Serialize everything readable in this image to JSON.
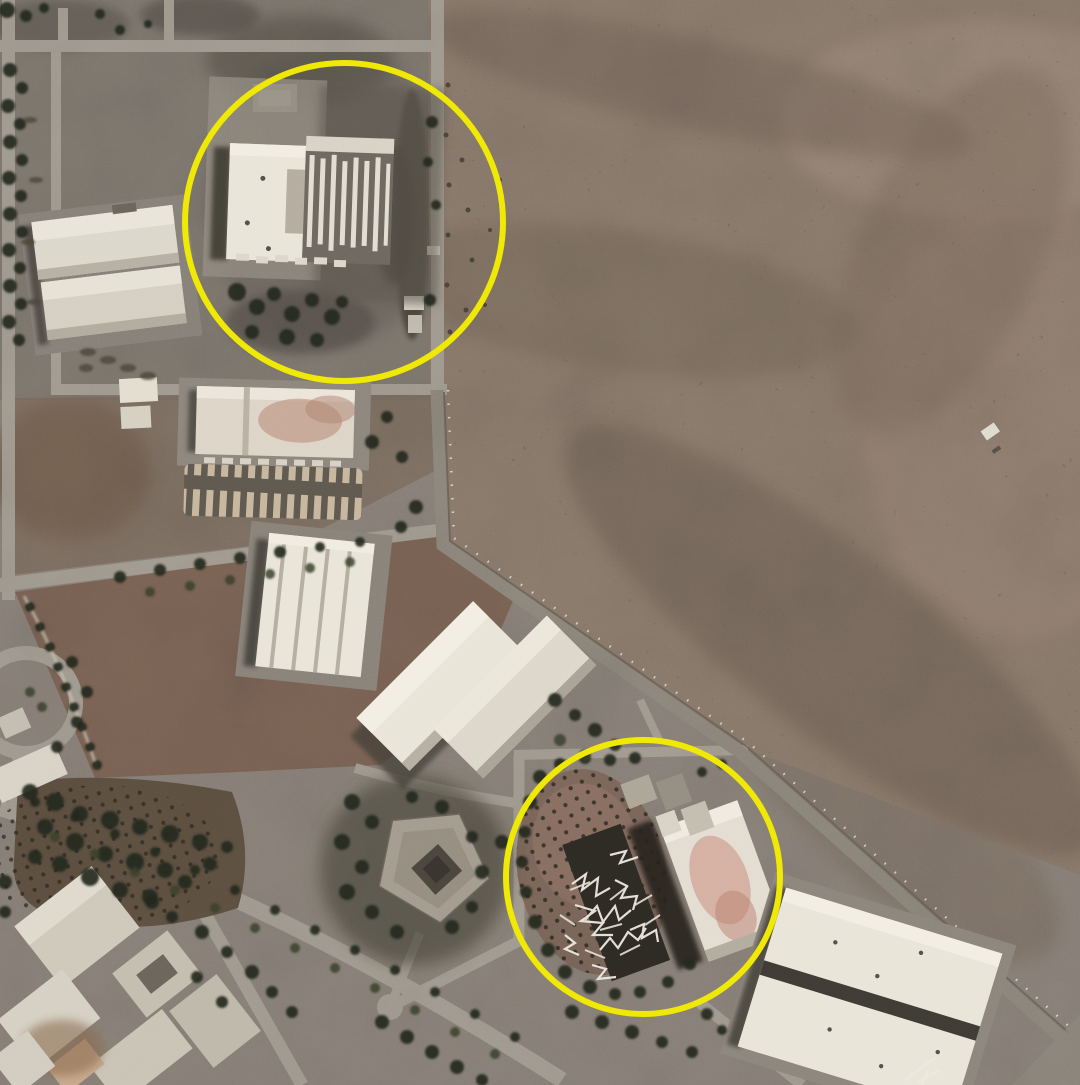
{
  "scene": {
    "type": "satellite-photograph",
    "description": "Overhead satellite view of an industrial facility bordered by desert terrain. Roads, warehouses, tree rows and orchards cover the lower-left; bare brown desert fills the upper right. Two yellow circles annotate blast-damaged buildings: one large destroyed-roof building in the north and one collapsed structure with scattered debris in the south.",
    "width_px": 1080,
    "height_px": 1085
  },
  "palette": {
    "annotation_yellow": "#f0e805",
    "facility_ground": "#8a8279",
    "upper_block_gray": "#7f786f",
    "desert_ground": "#8b7b6d",
    "desert_light": "#9c8a7a",
    "desert_dark": "#6f6156",
    "field_brown": "#7c6455",
    "orchard_brown": "#6a584a",
    "road_gray": "#a49d92",
    "building_white": "#e9e5d9",
    "building_gray": "#c9c3b6",
    "tree_dark": "#23281e",
    "shadow_dark": "#38342c",
    "burn_scar": "#4f4b43",
    "pink_stain": "#c98d7c"
  },
  "annotations": {
    "circles": [
      {
        "name": "north-damaged-building-circle",
        "cx": 344,
        "cy": 222,
        "r": 159,
        "stroke_width": 6
      },
      {
        "name": "south-damaged-building-circle",
        "cx": 643,
        "cy": 877,
        "r": 137,
        "stroke_width": 6
      }
    ]
  }
}
